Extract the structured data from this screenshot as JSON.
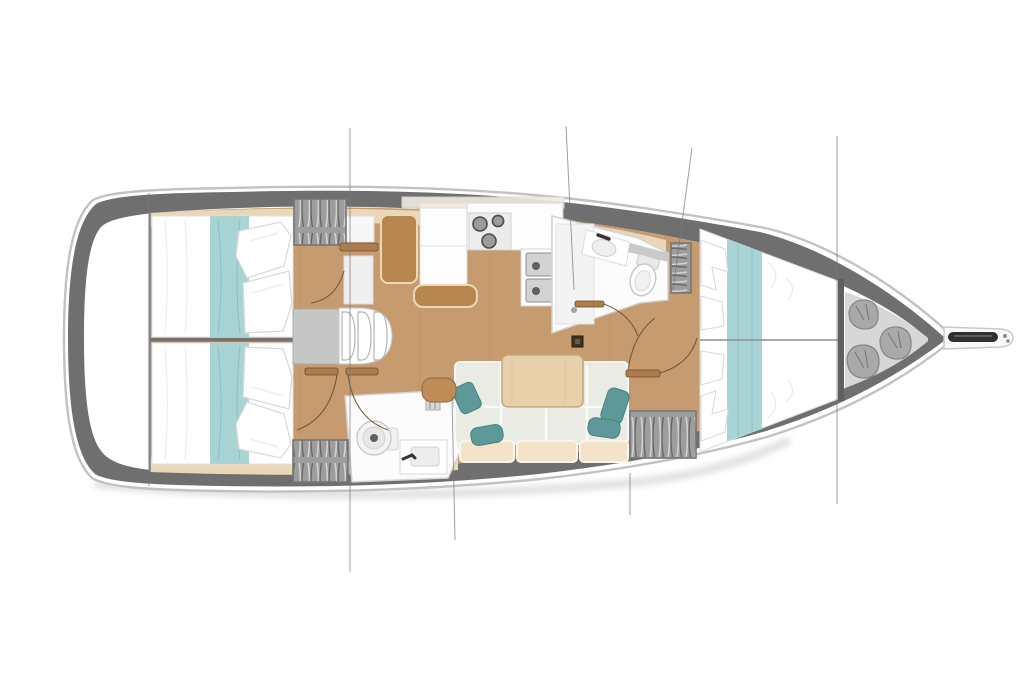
{
  "meta": {
    "type": "yacht-interior-deck-plan",
    "orientation": "bow-right",
    "width_px": 1024,
    "height_px": 676,
    "background": "#ffffff",
    "visible_text": []
  },
  "colors": {
    "hull_band": "#6f6f6f",
    "hull_outline": "#c2c2c2",
    "bulkhead_dark": "#5f5f5f",
    "floor_wood": "#c59b6f",
    "floor_wood_grain": "#b98d60",
    "side_deck_beige": "#ead7b7",
    "bed_linen": "#ffffff",
    "bed_runner_teal": "#a9d4d6",
    "cushion_gray": "#e9ebe4",
    "cushion_back_beige": "#f2e3c9",
    "pillow_teal": "#5f9899",
    "table_wood": "#e8d0aa",
    "seat_tan": "#b8864f",
    "stool_tan": "#bf8c58",
    "locker_gray": "#9d9d9d",
    "steps_gray": "#c6c6c6",
    "fixture_white": "#fcfcfc",
    "stainless": "#d2d2d2",
    "drain_dark": "#5f5f5f",
    "anchor_dark": "#303030",
    "bow_locker_bg": "#d7d7d7",
    "bag_gray": "#a9a9a9",
    "section_line": "#777777",
    "door_swing": "#6d4c2b",
    "door_leaf": "#ad7c4b",
    "mast_dark": "#3f3325"
  },
  "legend": {
    "areas": [
      {
        "id": "stern-platform",
        "label": "stern transom platform"
      },
      {
        "id": "aft-cabin-port",
        "label": "aft double cabin (upper)"
      },
      {
        "id": "aft-cabin-starboard",
        "label": "aft double cabin (lower)"
      },
      {
        "id": "companionway",
        "label": "companionway steps and landing"
      },
      {
        "id": "nav-station",
        "label": "chart table with tan seats"
      },
      {
        "id": "galley",
        "label": "galley with 3-burner stove and twin sinks"
      },
      {
        "id": "forward-head",
        "label": "forward head: shower, sink, toilet"
      },
      {
        "id": "aft-head",
        "label": "aft head: toilet and sink"
      },
      {
        "id": "salon",
        "label": "salon settee with teal pillows and wood table"
      },
      {
        "id": "wardrobes",
        "label": "hanging lockers with clothes"
      },
      {
        "id": "forward-cabin",
        "label": "forward V-berth double cabin"
      },
      {
        "id": "bow-locker",
        "label": "bow sail locker with stowed bags"
      },
      {
        "id": "bow-sprit",
        "label": "anchor roller / bow fitting"
      }
    ],
    "counts": {
      "double_beds": 3,
      "stove_burners": 3,
      "galley_sinks": 2,
      "companionway_steps": 3,
      "teal_pillows": 4,
      "bow_locker_bags": 3,
      "hanging_lockers": 4,
      "heads": 2,
      "section_lines": 7
    }
  }
}
